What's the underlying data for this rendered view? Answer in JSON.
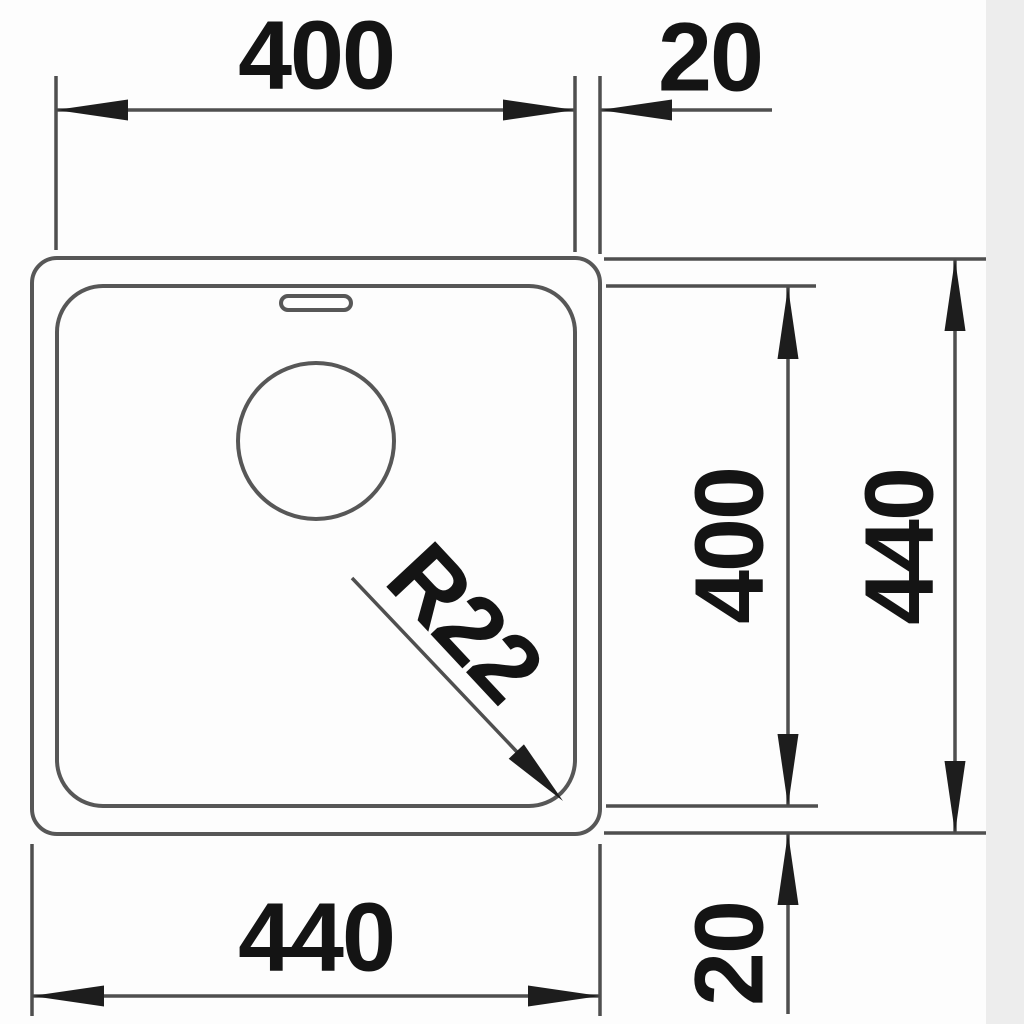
{
  "drawing": {
    "title": "Sink technical dimension drawing (top view)",
    "labels": {
      "top_width": "400",
      "top_rim": "20",
      "right_inner_height": "400",
      "right_outer_height": "440",
      "bottom_width": "440",
      "bottom_rim": "20",
      "corner_radius": "R22"
    },
    "colors": {
      "outline": "#575757",
      "dimension_line": "#4f4f4f",
      "arrow": "#1d1d1d",
      "text": "#141414",
      "background": "#fdfdfd",
      "right_edge_strip": "#ededed"
    }
  }
}
